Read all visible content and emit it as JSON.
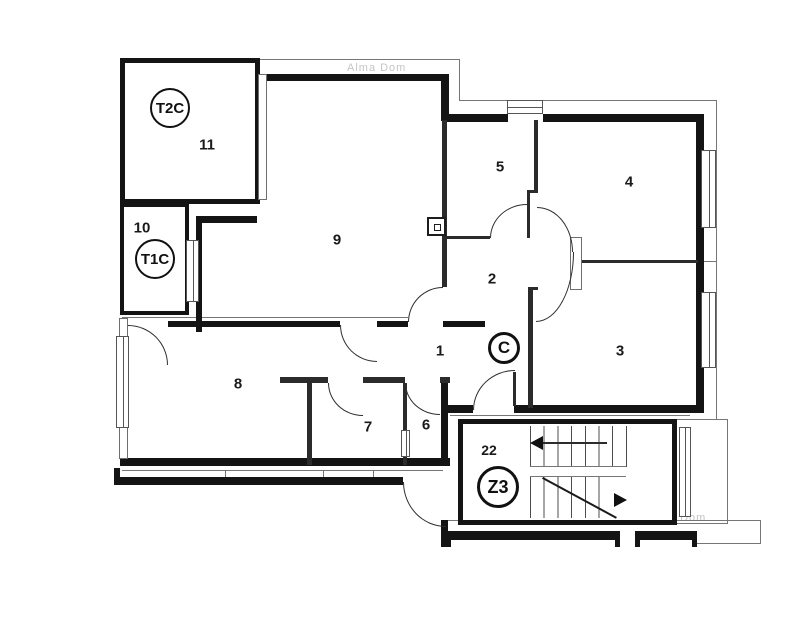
{
  "watermark": "Alma Dom",
  "badges": {
    "t2c": "T2C",
    "t1c": "T1C",
    "c": "C",
    "z3": "Z3"
  },
  "rooms": {
    "r1": "1",
    "r2": "2",
    "r3": "3",
    "r4": "4",
    "r5": "5",
    "r6": "6",
    "r7": "7",
    "r8": "8",
    "r9": "9",
    "r10": "10",
    "r11": "11",
    "r22": "22"
  }
}
